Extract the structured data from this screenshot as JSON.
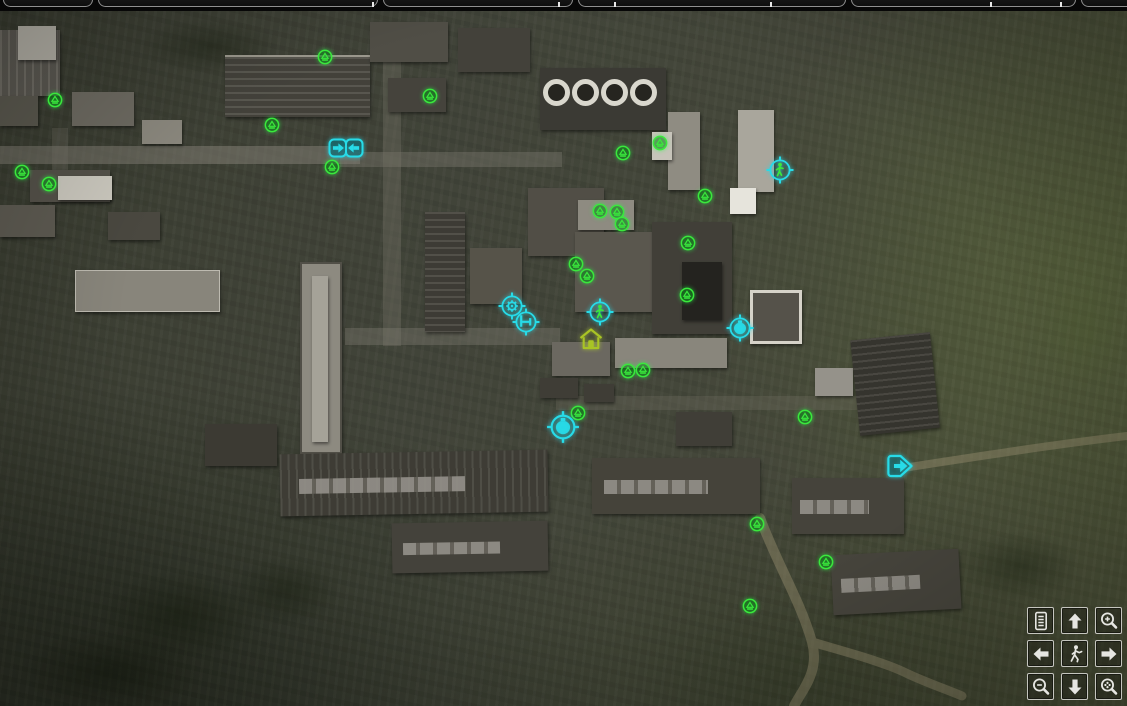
{
  "screen_title": "",
  "colors": {
    "stash_green": "#3ae83c",
    "quest_cyan": "#27dbe8",
    "house_green": "#a9c425",
    "button_border": "#d6d6d0",
    "tab_border": "#8f8f8f"
  },
  "tab_strip": {
    "tabs": [
      {
        "label": ""
      },
      {
        "label": ""
      },
      {
        "label": ""
      },
      {
        "label": ""
      },
      {
        "label": ""
      },
      {
        "label": ""
      }
    ]
  },
  "map": {
    "markers": [
      {
        "type": "stash",
        "x": 55,
        "y": 100
      },
      {
        "type": "stash",
        "x": 325,
        "y": 57
      },
      {
        "type": "stash",
        "x": 430,
        "y": 96
      },
      {
        "type": "stash",
        "x": 272,
        "y": 125
      },
      {
        "type": "stash",
        "x": 332,
        "y": 167
      },
      {
        "type": "stash",
        "x": 22,
        "y": 172
      },
      {
        "type": "stash",
        "x": 49,
        "y": 184
      },
      {
        "type": "stash",
        "x": 623,
        "y": 153
      },
      {
        "type": "stash",
        "x": 660,
        "y": 143
      },
      {
        "type": "stash",
        "x": 705,
        "y": 196
      },
      {
        "type": "stash",
        "x": 600,
        "y": 211
      },
      {
        "type": "stash",
        "x": 617,
        "y": 212
      },
      {
        "type": "stash",
        "x": 622,
        "y": 224
      },
      {
        "type": "stash",
        "x": 688,
        "y": 243
      },
      {
        "type": "stash",
        "x": 576,
        "y": 264
      },
      {
        "type": "stash",
        "x": 587,
        "y": 276
      },
      {
        "type": "stash",
        "x": 687,
        "y": 295
      },
      {
        "type": "stash",
        "x": 628,
        "y": 371
      },
      {
        "type": "stash",
        "x": 643,
        "y": 370
      },
      {
        "type": "stash",
        "x": 578,
        "y": 413
      },
      {
        "type": "stash",
        "x": 805,
        "y": 417
      },
      {
        "type": "stash",
        "x": 757,
        "y": 524
      },
      {
        "type": "stash",
        "x": 826,
        "y": 562
      },
      {
        "type": "stash",
        "x": 750,
        "y": 606
      },
      {
        "type": "transition-pair",
        "x": 346,
        "y": 148
      },
      {
        "type": "npc",
        "x": 780,
        "y": 170
      },
      {
        "type": "technician",
        "x": 512,
        "y": 306
      },
      {
        "type": "rest",
        "x": 526,
        "y": 322
      },
      {
        "type": "npc",
        "x": 600,
        "y": 312
      },
      {
        "type": "house",
        "x": 591,
        "y": 339
      },
      {
        "type": "flask",
        "x": 740,
        "y": 328
      },
      {
        "type": "flask-large",
        "x": 563,
        "y": 427
      },
      {
        "type": "transition-east",
        "x": 901,
        "y": 466
      }
    ]
  },
  "controls": {
    "buttons": [
      {
        "name": "notes",
        "icon": "document-icon"
      },
      {
        "name": "pan-up",
        "icon": "arrow-up-icon"
      },
      {
        "name": "zoom-in",
        "icon": "magnifier-plus-icon"
      },
      {
        "name": "pan-left",
        "icon": "arrow-left-icon"
      },
      {
        "name": "center-on-player",
        "icon": "walker-icon"
      },
      {
        "name": "pan-right",
        "icon": "arrow-right-icon"
      },
      {
        "name": "zoom-out",
        "icon": "magnifier-minus-icon"
      },
      {
        "name": "pan-down",
        "icon": "arrow-down-icon"
      },
      {
        "name": "zoom-reset",
        "icon": "magnifier-target-icon"
      }
    ]
  }
}
